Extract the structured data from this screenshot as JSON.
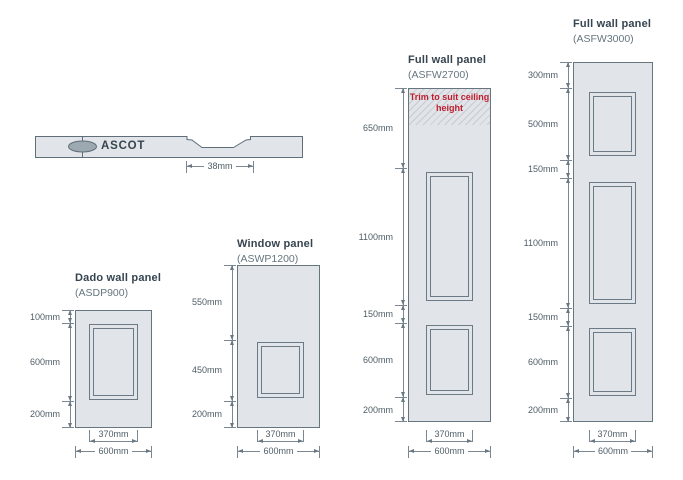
{
  "colors": {
    "panel_fill": "#e1e4e8",
    "panel_border": "#67757e",
    "dimension_line": "#7b8893",
    "dimension_text": "#4e5d66",
    "title_text": "#36444f",
    "code_text": "#66767f",
    "warning_red": "#bf1e2e",
    "logo_gray": "#9da9b0"
  },
  "profile": {
    "brand": "ASCOT",
    "groove_width": "38mm"
  },
  "panels": [
    {
      "title": "Dado wall panel",
      "code": "(ASDP900)",
      "left_dims": [
        "100mm",
        "600mm",
        "200mm"
      ],
      "width_dims": [
        "370mm",
        "600mm"
      ]
    },
    {
      "title": "Window panel",
      "code": "(ASWP1200)",
      "left_dims": [
        "550mm",
        "450mm",
        "200mm"
      ],
      "width_dims": [
        "370mm",
        "600mm"
      ]
    },
    {
      "title": "Full wall panel",
      "code": "(ASFW2700)",
      "note": "Trim to suit ceiling height",
      "left_dims": [
        "650mm",
        "1100mm",
        "150mm",
        "600mm",
        "200mm"
      ],
      "width_dims": [
        "370mm",
        "600mm"
      ]
    },
    {
      "title": "Full wall panel",
      "code": "(ASFW3000)",
      "left_dims": [
        "300mm",
        "500mm",
        "150mm",
        "1100mm",
        "150mm",
        "600mm",
        "200mm"
      ],
      "width_dims": [
        "370mm",
        "600mm"
      ]
    }
  ]
}
